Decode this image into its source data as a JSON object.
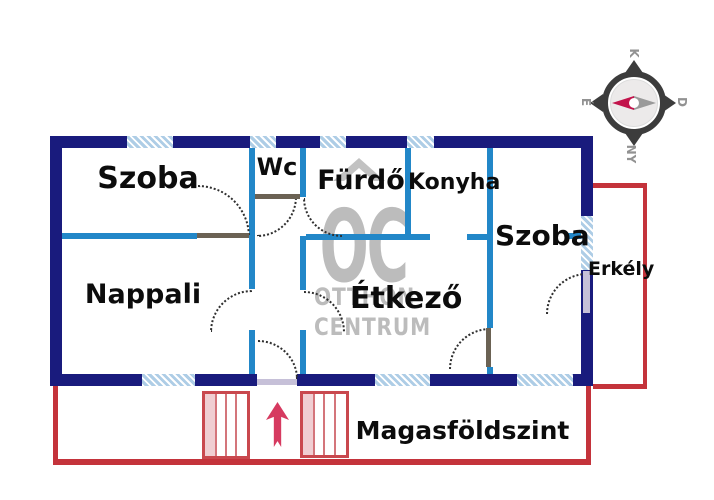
{
  "labels": {
    "szoba_tl": "Szoba",
    "wc": "Wc",
    "furdo": "Fürdő",
    "konyha": "Konyha",
    "szoba_r": "Szoba",
    "nappali": "Nappali",
    "etkezo": "Étkező",
    "erkely": "Erkély",
    "floor": "Magasföldszint"
  },
  "watermark": {
    "logo": "OC",
    "name_line1": "OTTHON",
    "name_line2": "CENTRUM"
  },
  "compass": {
    "top": "K",
    "right": "D",
    "bottom": "NY",
    "left": "É"
  },
  "colors": {
    "outer_wall": "#191b7d",
    "inner_wall": "#2287c8",
    "window_fill": "#aecde6",
    "red_outline": "#c4333b",
    "stairs_red": "#c9484e",
    "arrow_red": "#d63a60",
    "watermark_gray": "#bcbcbc",
    "door_leaf": "#6b6254",
    "door_sill": "#c6c0d8",
    "compass_dark": "#3c3c3c",
    "compass_needle_red": "#c2134b",
    "compass_needle_gray": "#9a9a9a"
  }
}
